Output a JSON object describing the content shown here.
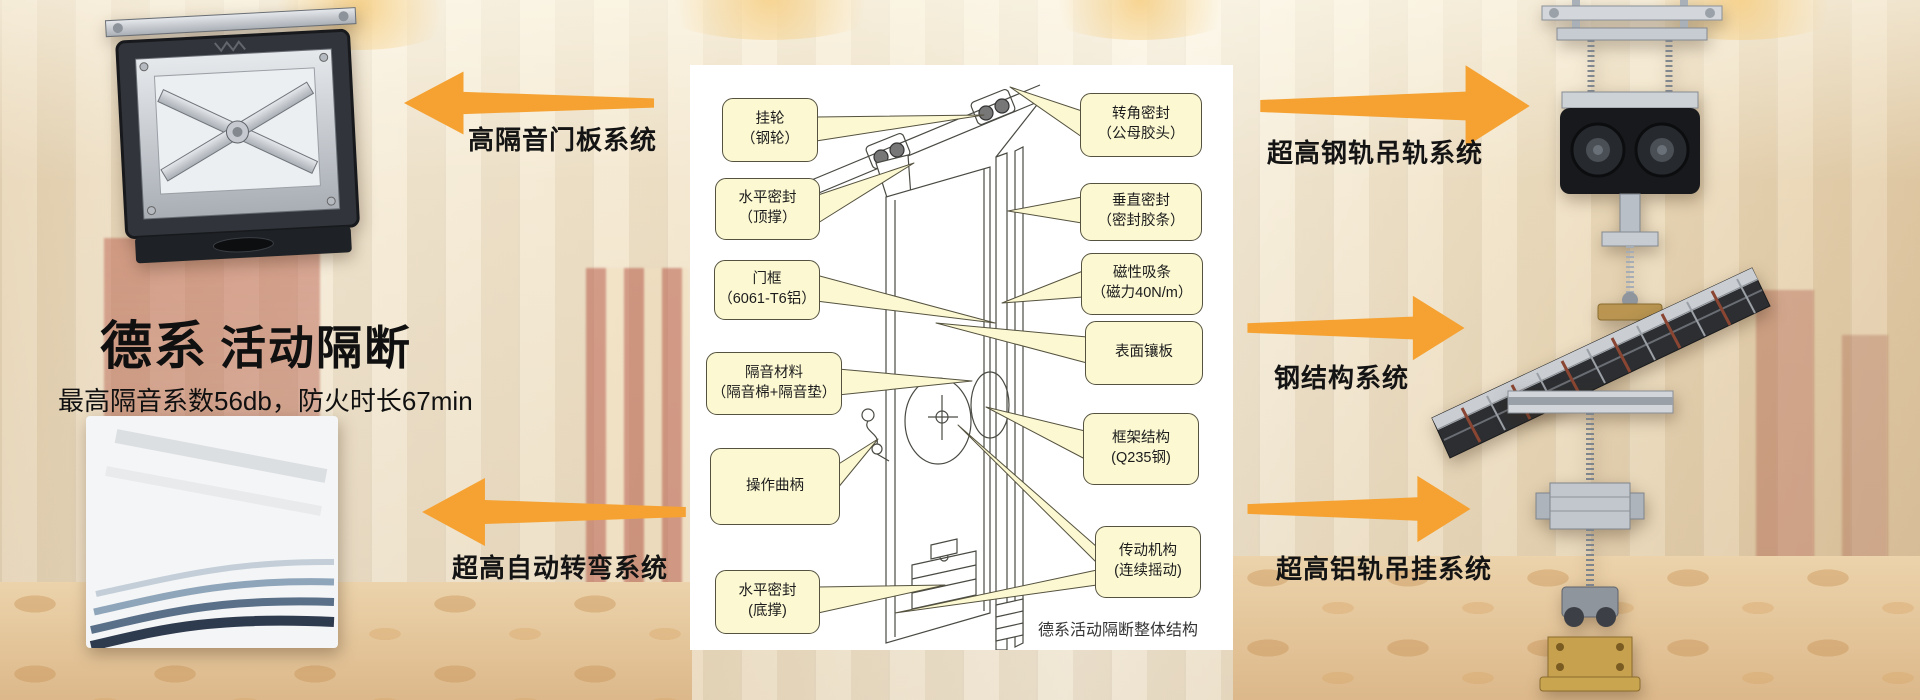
{
  "page": {
    "brand": "德系",
    "product": "活动隔断",
    "subtitle": "最高隔音系数56db，防火时长67min"
  },
  "systems": {
    "left_top": "高隔音门板系统",
    "left_bottom": "超高自动转弯系统",
    "right_top": "超高钢轨吊轨系统",
    "right_middle": "钢结构系统",
    "right_bottom": "超高铝轨吊挂系统"
  },
  "diagram": {
    "caption": "德系活动隔断整体结构",
    "callouts_left": [
      {
        "line1": "挂轮",
        "line2": "（钢轮）"
      },
      {
        "line1": "水平密封",
        "line2": "（顶撑）"
      },
      {
        "line1": "门框",
        "line2": "（6061-T6铝）"
      },
      {
        "line1": "隔音材料",
        "line2": "（隔音棉+隔音垫）"
      },
      {
        "line1": "操作曲柄",
        "line2": ""
      },
      {
        "line1": "水平密封",
        "line2": "(底撑)"
      }
    ],
    "callouts_right": [
      {
        "line1": "转角密封",
        "line2": "（公母胶头）"
      },
      {
        "line1": "垂直密封",
        "line2": "（密封胶条）"
      },
      {
        "line1": "磁性吸条",
        "line2": "（磁力40N/m）"
      },
      {
        "line1": "表面镶板",
        "line2": ""
      },
      {
        "line1": "框架结构",
        "line2": "(Q235钢)"
      },
      {
        "line1": "传动机构",
        "line2": "(连续摇动)"
      }
    ]
  },
  "photos": {
    "top_left": "door-panel-mechanism",
    "bottom_left": "curved-track-sections",
    "top_right": "steel-rail-trolley",
    "middle_right": "steel-structure-frame",
    "bottom_right": "aluminum-rail-hanger"
  },
  "colors": {
    "arrow": "#F5A233",
    "callout_fill": "#FBF8D2",
    "callout_border": "#55523F",
    "background": "#F3E6CC",
    "text": "#141414"
  }
}
